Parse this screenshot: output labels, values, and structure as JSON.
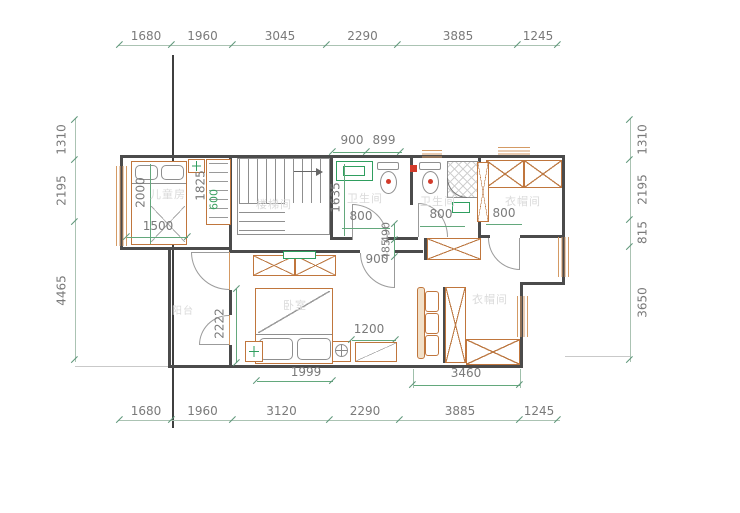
{
  "colors": {
    "wall": "#4b4b4b",
    "dimension_line": "#abc3b3",
    "inner_dimension_line": "#63a87c",
    "dimension_text": "#7a7a7a",
    "furniture_outline": "#c0763d",
    "window_outline": "#d49a64",
    "fixture_green": "#2f9e5f",
    "marker_red": "#d23a2a",
    "room_label": "#dadada"
  },
  "dims": {
    "top": [
      "1680",
      "1960",
      "3045",
      "2290",
      "3885",
      "1245"
    ],
    "bottom": [
      "1680",
      "1960",
      "3120",
      "2290",
      "3885",
      "1245"
    ],
    "left": [
      "1310",
      "2195",
      "4465"
    ],
    "right": [
      "1310",
      "2195",
      "815",
      "3650"
    ]
  },
  "rooms": {
    "children": "儿童房",
    "stairwell": "楼梯间",
    "bath1": "卫生间",
    "bath2": "卫生间",
    "closet_top": "衣帽间",
    "bedroom": "卧室",
    "closet_bottom": "衣帽间",
    "balcony": "阳台"
  },
  "inner": {
    "bed2000": "2000",
    "bed1500": "1500",
    "closet1825": "1825",
    "closet600": "600",
    "bath900": "900",
    "bath899": "899",
    "bath1635": "1635",
    "bathdoor800": "800",
    "bath2_800": "800",
    "closettop800": "800",
    "hall490": "490",
    "hall485": "485",
    "halldoor900": "900",
    "bed2222": "2222",
    "bed1999": "1999",
    "bench1200": "1200",
    "closet3460": "3460"
  }
}
